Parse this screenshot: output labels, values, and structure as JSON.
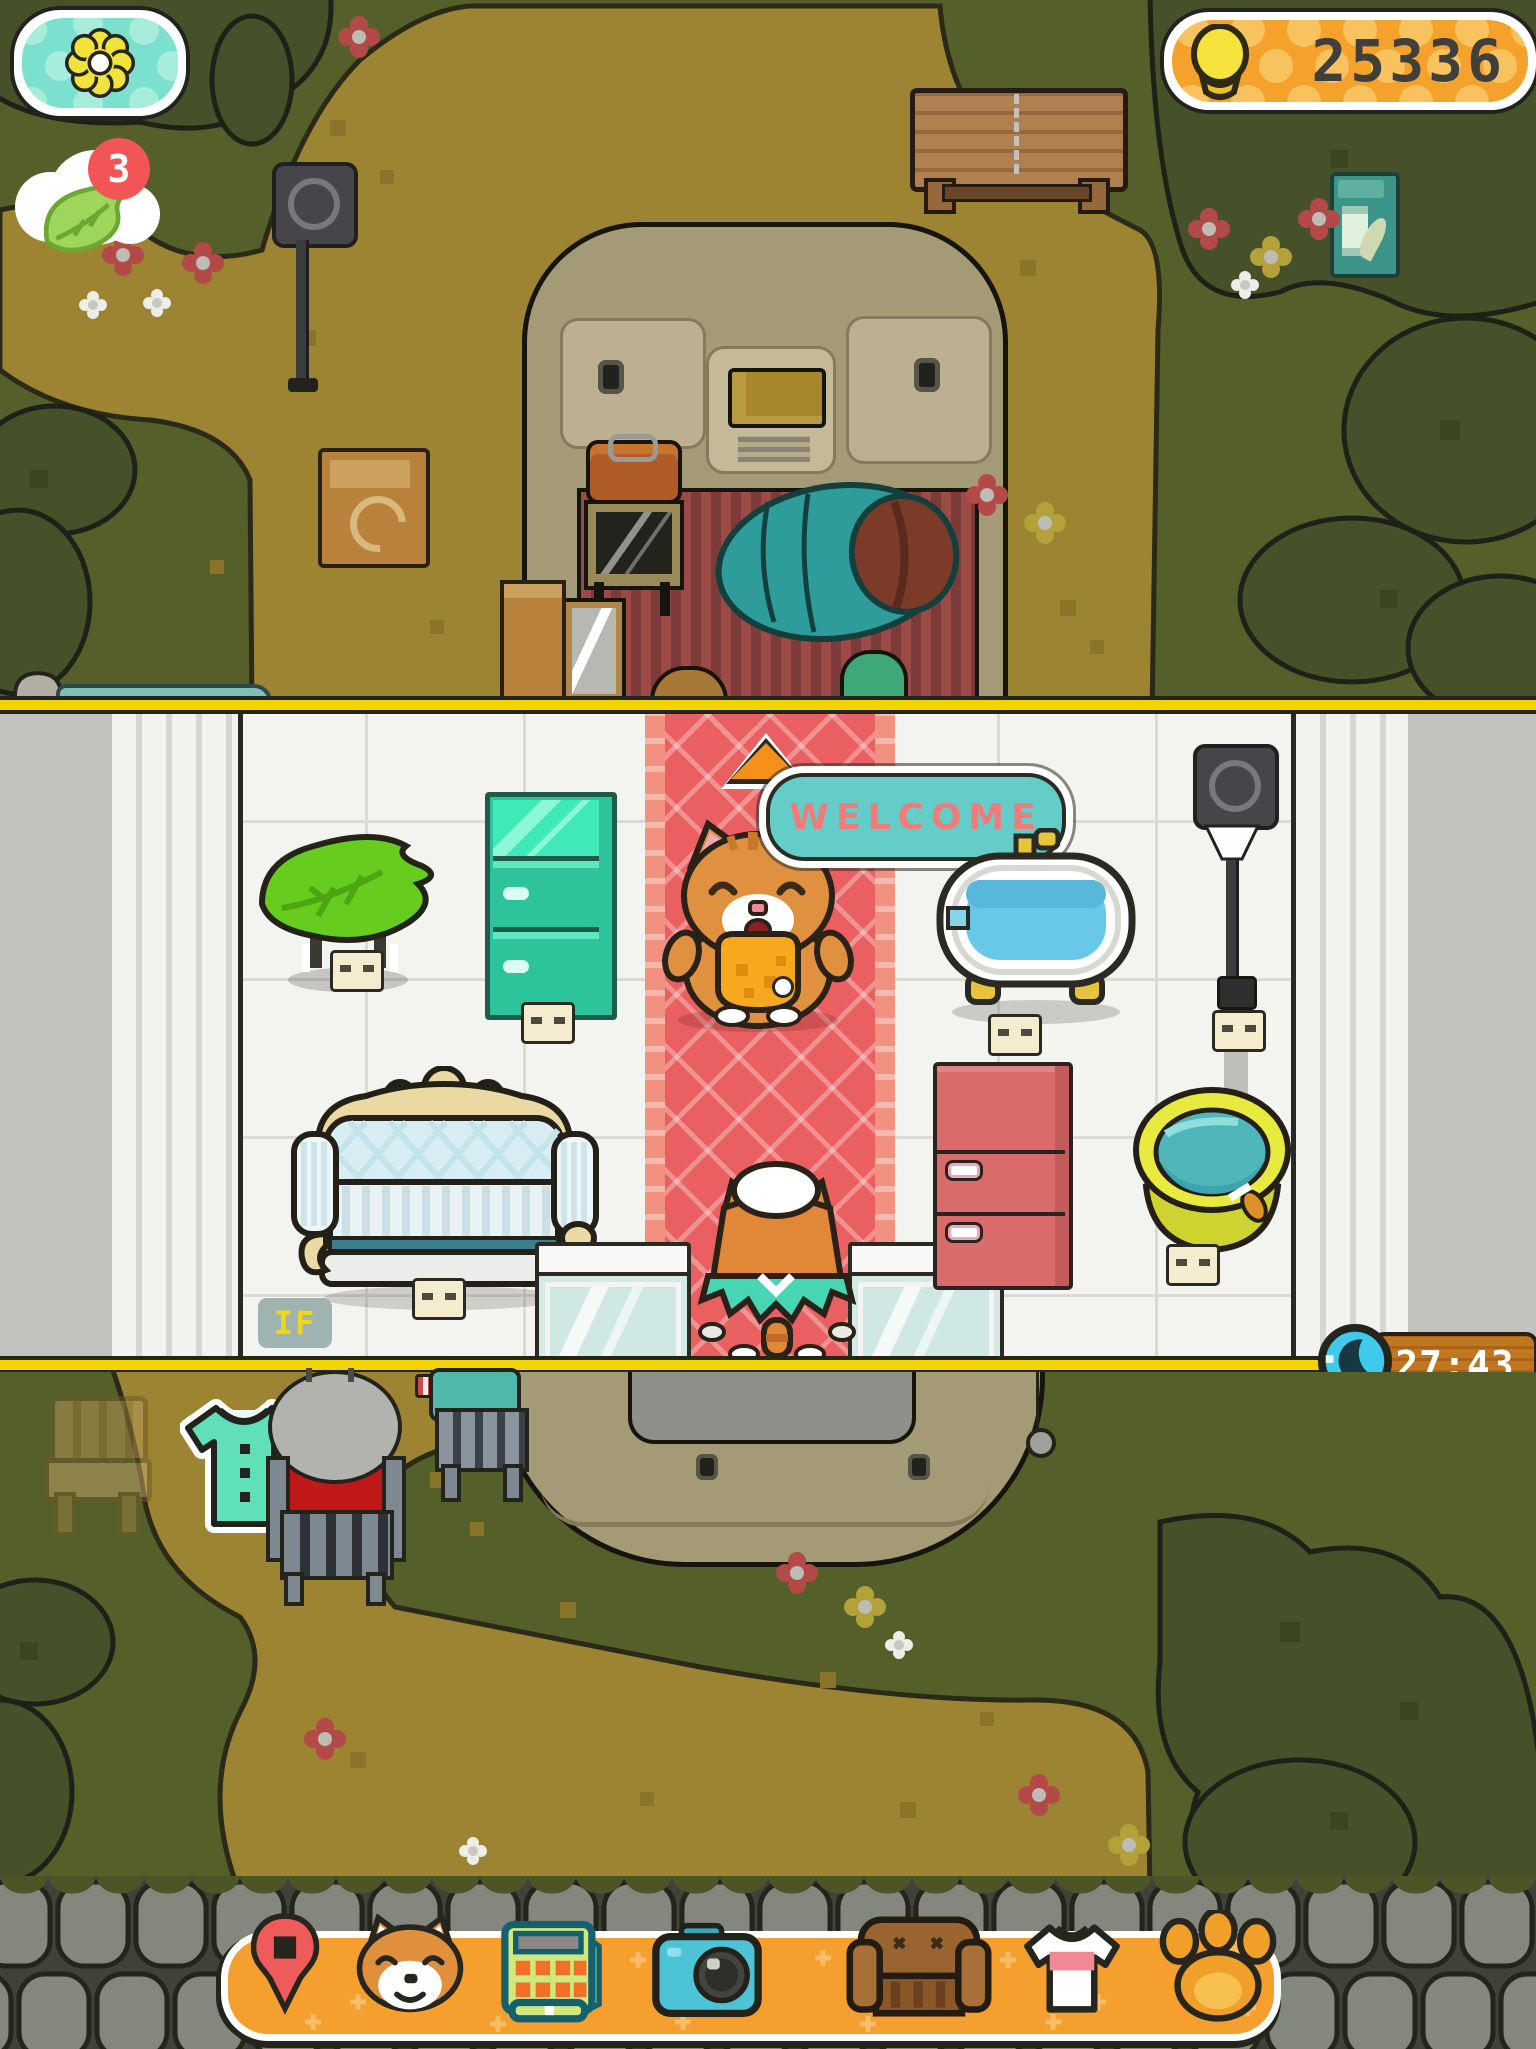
{
  "colors": {
    "accent_orange": "#f59f2e",
    "hud_teal": "#7ce0cf",
    "coin_gold": "#f5e23c",
    "carpet_red": "#ea5f5f",
    "welcome_fill": "#65cdc7",
    "welcome_text": "#f27a7a",
    "timer_wood": "#c1761f",
    "grass_green": "#545f29",
    "dirt_tan": "#9c8433",
    "badge_red": "#f25555"
  },
  "hud": {
    "flower_button": {
      "icon": "flower-icon"
    },
    "coin_counter": {
      "icon": "coin-icon",
      "value": "25336"
    },
    "leaf_notification": {
      "icon": "leaf-icon",
      "badge_count": "3"
    },
    "capacity_meter": {
      "icon": "house-icon",
      "value": "413/100"
    },
    "timer": {
      "icon": "moon-icon",
      "value": "27:43"
    }
  },
  "shop": {
    "speech_bubble": {
      "text": "WELCOME"
    },
    "doormat": {
      "text": "IF"
    },
    "furniture": [
      "leaf-table",
      "teal-fridge",
      "bathtub",
      "shop-lamp",
      "sofa",
      "pink-fridge",
      "water-bucket",
      "glass-counter-left",
      "glass-counter-right"
    ],
    "characters": [
      "shopkeeper-cat",
      "visitor-cat"
    ]
  },
  "outdoor": {
    "items": [
      "camper-van",
      "bench",
      "lamp-post",
      "newspaper-box",
      "cardboard-box",
      "ghost-chair",
      "shirt-item",
      "npc-cat-on-chair",
      "npc-chair",
      "fishing-bobber"
    ]
  },
  "toolbar": {
    "items": [
      {
        "icon": "map-pin-icon"
      },
      {
        "icon": "shiba-icon"
      },
      {
        "icon": "cash-register-icon"
      },
      {
        "icon": "camera-icon"
      },
      {
        "icon": "armchair-icon"
      },
      {
        "icon": "tshirt-icon"
      },
      {
        "icon": "paw-icon"
      }
    ]
  }
}
